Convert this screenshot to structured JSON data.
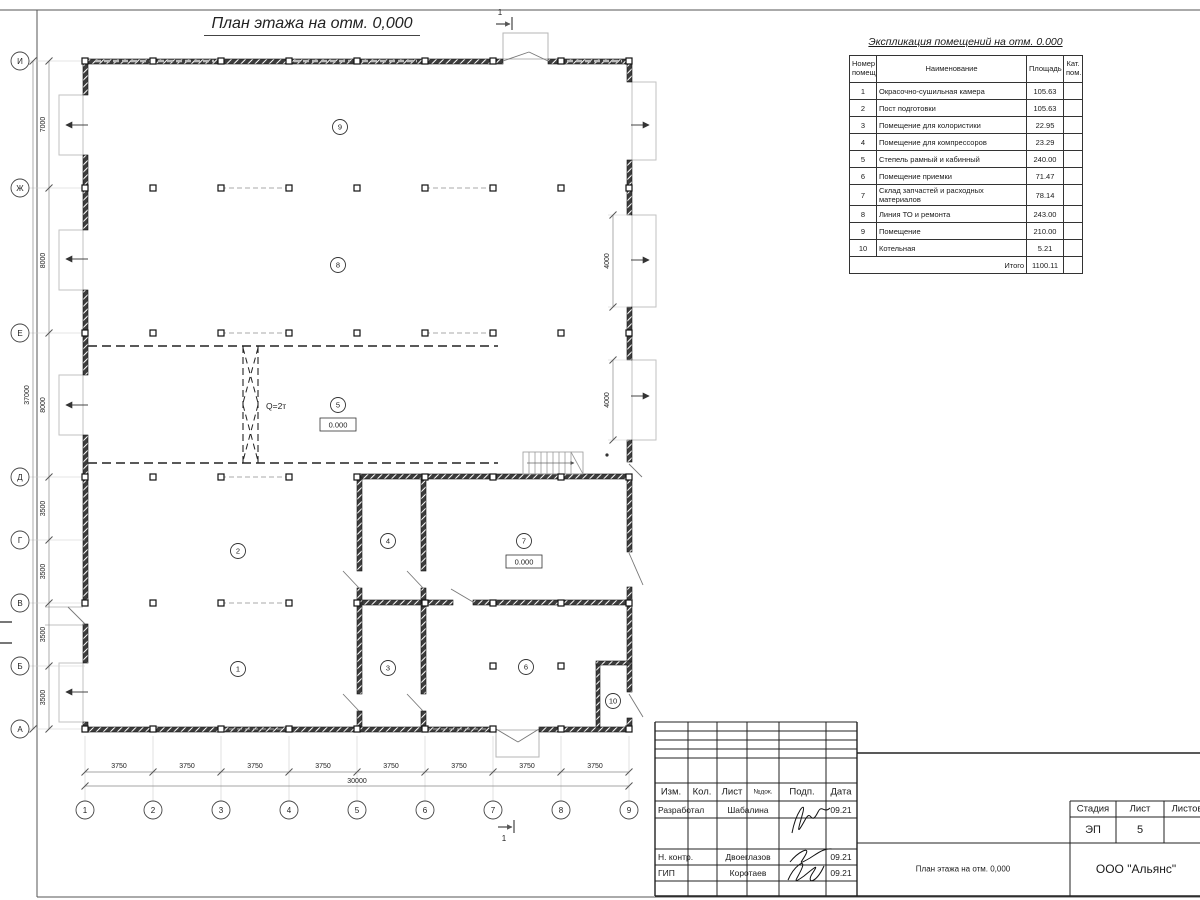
{
  "sheet": {
    "title": "План этажа на отм. 0,000",
    "section_mark_label": "1"
  },
  "plan": {
    "grid": {
      "col_labels": [
        "1",
        "2",
        "3",
        "4",
        "5",
        "6",
        "7",
        "8",
        "9"
      ],
      "row_labels": [
        "И",
        "Ж",
        "Е",
        "Д",
        "Г",
        "В",
        "Б",
        "А"
      ],
      "col_dim_labels": [
        "3750",
        "3750",
        "3750",
        "3750",
        "3750",
        "3750",
        "3750",
        "3750"
      ],
      "col_total_label": "30000",
      "row_dim_labels": [
        "7000",
        "8000",
        "8000",
        "3500",
        "3500",
        "3500",
        "3500"
      ],
      "row_total_label": "37000"
    },
    "rooms": [
      {
        "num": "9"
      },
      {
        "num": "8"
      },
      {
        "num": "5",
        "elevation": "0.000"
      },
      {
        "num": "2"
      },
      {
        "num": "4"
      },
      {
        "num": "7",
        "elevation": "0.000"
      },
      {
        "num": "1"
      },
      {
        "num": "3"
      },
      {
        "num": "6"
      },
      {
        "num": "10"
      }
    ],
    "crane_capacity_label": "Q=2т",
    "gate_dim_labels": [
      "4000",
      "4000"
    ]
  },
  "schedule": {
    "title": "Экспликация помещений на отм. 0.000",
    "headers": [
      "Номер помещ.",
      "Наименование",
      "Площадь",
      "Кат. пом."
    ],
    "rows": [
      [
        "1",
        "Окрасочно-сушильная камера",
        "105.63"
      ],
      [
        "2",
        "Пост подготовки",
        "105.63"
      ],
      [
        "3",
        "Помещение для колористики",
        "22.95"
      ],
      [
        "4",
        "Помещение для компрессоров",
        "23.29"
      ],
      [
        "5",
        "Степель рамный и кабинный",
        "240.00"
      ],
      [
        "6",
        "Помещение приемки",
        "71.47"
      ],
      [
        "7",
        "Склад запчастей и расходных материалов",
        "78.14"
      ],
      [
        "8",
        "Линия ТО и ремонта",
        "243.00"
      ],
      [
        "9",
        "Помещение",
        "210.00"
      ],
      [
        "10",
        "Котельная",
        "5.21"
      ]
    ],
    "total_label": "Итого",
    "total_value": "1100.11"
  },
  "titleblock": {
    "header_cols": [
      "Изм.",
      "Кол.",
      "Лист",
      "№док.",
      "Подп.",
      "Дата"
    ],
    "signature_rows": [
      {
        "role": "Разработал",
        "name": "Шабалина",
        "date": "09.21"
      },
      {
        "role": "Н. контр.",
        "name": "Двоеглазов",
        "date": "09.21"
      },
      {
        "role": "ГИП",
        "name": "Коротаев",
        "date": "09.21"
      }
    ],
    "stage_headers": [
      "Стадия",
      "Лист",
      "Листов"
    ],
    "stage_value": "ЭП",
    "sheet_value": "5",
    "doc_title": "План этажа на отм. 0,000",
    "company": "ООО \"Альянс\""
  }
}
